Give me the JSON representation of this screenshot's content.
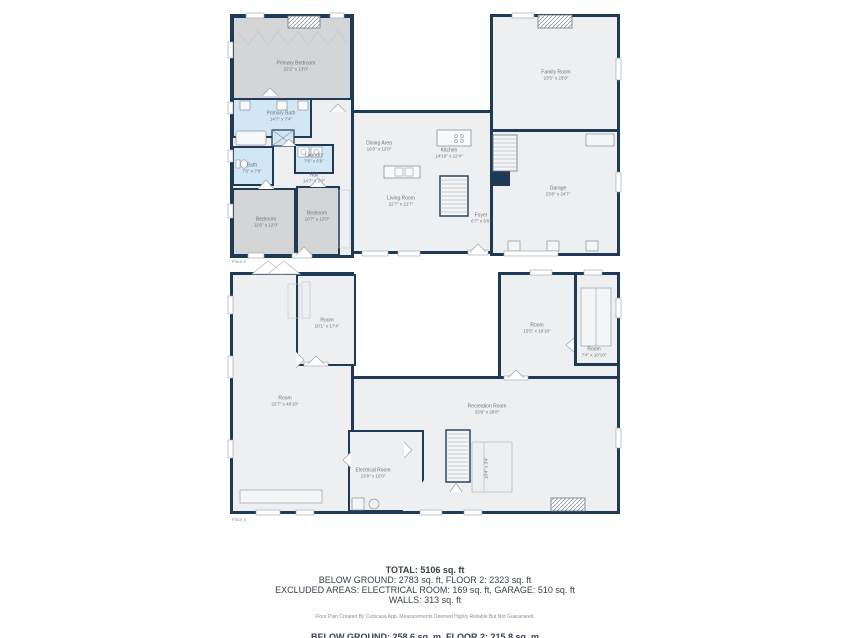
{
  "palette": {
    "wall": "#1e3a54",
    "floor": "#edeff1",
    "room_gray": "#d3d5d7",
    "room_blue": "#d2e6f3",
    "label_text": "#6b7682",
    "summary_text": "#39424c",
    "muted_text": "#8a9097"
  },
  "floor2": {
    "label": "Floor 2",
    "rooms": [
      {
        "name": "Primary Bedroom",
        "dims": "22'2\" x 13'0\""
      },
      {
        "name": "Primary Bath",
        "dims": "14'7\" x 7'4\""
      },
      {
        "name": "Bath",
        "dims": "7'6\" x 7'6\""
      },
      {
        "name": "Laundry",
        "dims": "7'6\" x 6'9\""
      },
      {
        "name": "Hall",
        "dims": "14'7\" x 2'7\""
      },
      {
        "name": "Bedroom",
        "dims": "11'6\" x 12'0\""
      },
      {
        "name": "Bedroom",
        "dims": "10'7\" x 12'0\""
      },
      {
        "name": "Dining Area",
        "dims": "16'0\" x 12'0\""
      },
      {
        "name": "Kitchen",
        "dims": "14'10\" x 12'4\""
      },
      {
        "name": "Living Room",
        "dims": "22'7\" x 21'7\""
      },
      {
        "name": "Foyer",
        "dims": "6'7\" x 6'0\""
      },
      {
        "name": "Family Room",
        "dims": "23'5\" x 23'9\""
      },
      {
        "name": "Garage",
        "dims": "23'8\" x 24'7\""
      }
    ]
  },
  "floor1": {
    "label": "Floor 1",
    "rooms": [
      {
        "name": "Room",
        "dims": "22'7\" x 46'10\""
      },
      {
        "name": "Room",
        "dims": "10'1\" x 17'4\""
      },
      {
        "name": "Room",
        "dims": "15'5\" x 19'10\""
      },
      {
        "name": "Room",
        "dims": "7'4\" x 10'10\""
      },
      {
        "name": "Recreation Room",
        "dims": "33'9\" x 28'8\""
      },
      {
        "name": "Electrical Room",
        "dims": "13'8\" x 12'0\""
      },
      {
        "name": "Closet",
        "dims": "10'4\" x 3'4\""
      }
    ]
  },
  "summary": {
    "line1": "TOTAL: 5106 sq. ft",
    "line2": "BELOW GROUND: 2783 sq. ft, FLOOR 2: 2323 sq. ft",
    "line3": "EXCLUDED AREAS: ELECTRICAL ROOM: 169 sq. ft, GARAGE: 510 sq. ft",
    "line4": "WALLS: 313 sq. ft",
    "disclaimer": "Floor Plan Created By Cubicasa App. Measurements Deemed Highly Reliable But Not Guaranteed.",
    "metric_line": "BELOW GROUND: 258.6 sq. m, FLOOR 2: 215.8 sq. m"
  }
}
